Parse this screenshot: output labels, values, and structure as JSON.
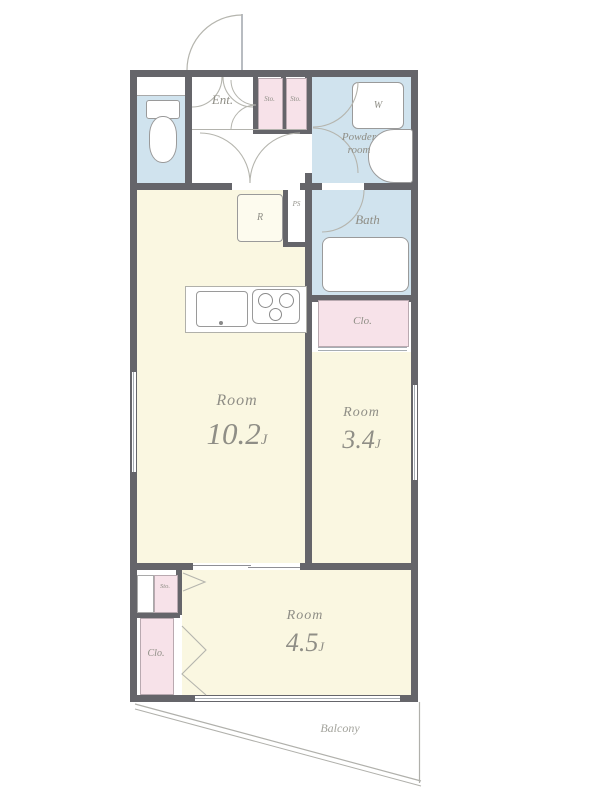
{
  "plan": {
    "rooms": [
      {
        "name": "Room",
        "size": "10.2",
        "unit": "J"
      },
      {
        "name": "Room",
        "size": "3.4",
        "unit": "J"
      },
      {
        "name": "Room",
        "size": "4.5",
        "unit": "J"
      }
    ],
    "areas": {
      "entrance": "Ent.",
      "powder_room_line1": "Powder",
      "powder_room_line2": "room",
      "bath": "Bath",
      "balcony": "Balcony",
      "closet_right": "Clo.",
      "closet_bottom": "Clo.",
      "storage_top_1": "Sto.",
      "storage_top_2": "Sto.",
      "storage_bottom": "Sto."
    },
    "fixtures": {
      "refrigerator": "R",
      "pipe_space": "PS",
      "washer": "W"
    },
    "colors": {
      "wall": "#65656a",
      "room_floor": "#faf7e1",
      "wet_area": "#d0e3ee",
      "closet": "#f7e2e9",
      "label_text": "#8f8e86",
      "thin_line": "#a7adb3"
    }
  }
}
